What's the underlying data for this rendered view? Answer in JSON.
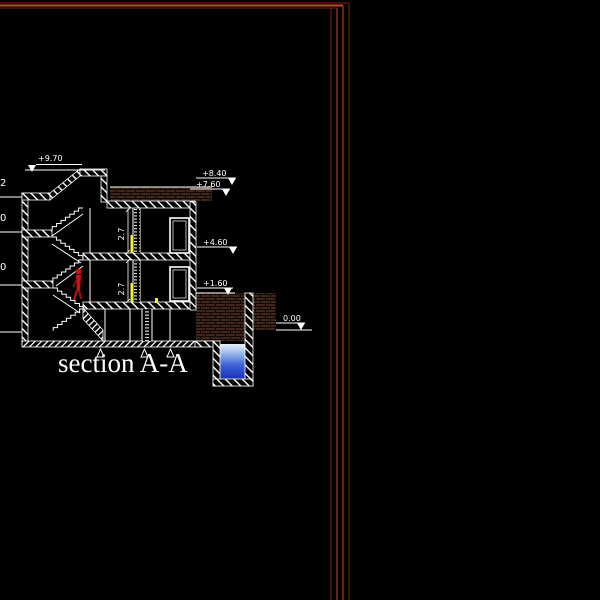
{
  "title": "section A-A",
  "markers": {
    "m970": {
      "label": "+9.70"
    },
    "m840": {
      "label": "+8.40"
    },
    "m760": {
      "label": "+7.60"
    },
    "m460": {
      "label": "+4.60"
    },
    "m160": {
      "label": "+1.60"
    },
    "m000": {
      "label": "0.00"
    }
  },
  "room_heights": {
    "upper": "2.7",
    "lower": "2.7"
  },
  "left_dims": {
    "d1": "2",
    "d2": "0",
    "d3": "0"
  },
  "colors": {
    "background": "#000000",
    "line_white": "#ffffff",
    "frame_red_bright": "#c84630",
    "frame_red_dark": "#7a251b",
    "brick": "#40251b",
    "mortar": "#120905",
    "figure_red": "#c81414",
    "door_yellow": "#f2f22e",
    "water_top": "#e8f1fb",
    "water_bottom": "#1b2fb4"
  }
}
